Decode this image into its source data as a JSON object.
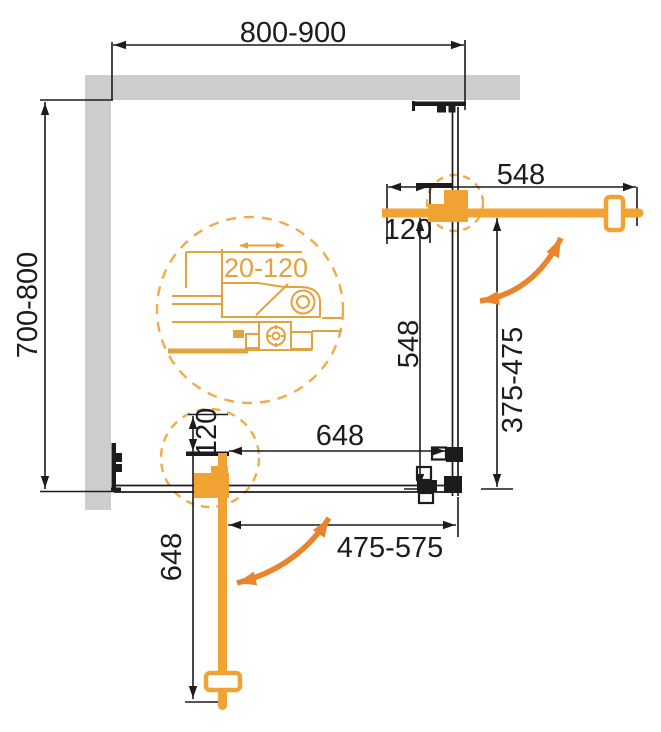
{
  "colors": {
    "wall": "#CDCDCD",
    "line": "#1C1C1C",
    "accent": "#F0A232",
    "arrow": "#E8842B",
    "dash": "#EFAC48",
    "detail": "#E3A23E"
  },
  "labels": {
    "width_total": "800-900",
    "depth_total": "700-800",
    "top_door_width": "548",
    "top_door_adjust": "120",
    "right_side_height": "548",
    "right_opening": "375-475",
    "bottom_door_width": "648",
    "bottom_opening": "475-575",
    "bottom_door_adjust": "120",
    "bottom_door_length": "648",
    "detail_adjust_range": "20-120"
  }
}
